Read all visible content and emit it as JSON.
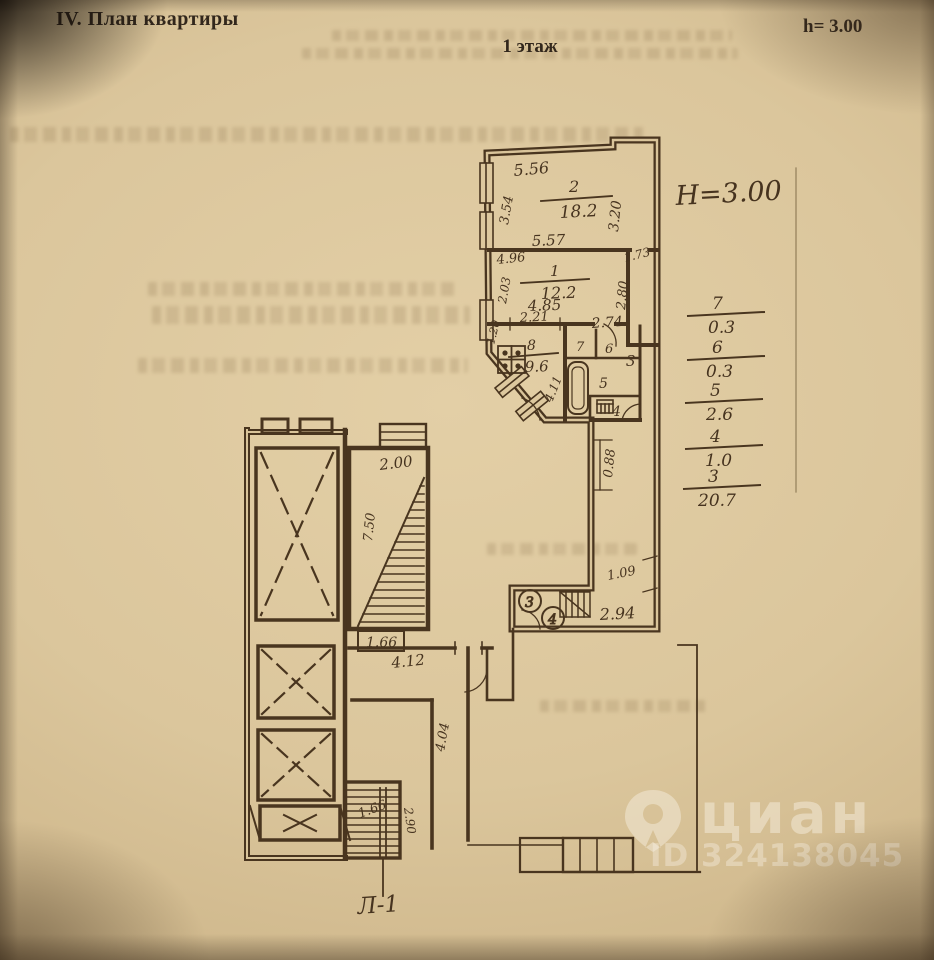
{
  "header": {
    "section_title": "IV. План квартиры",
    "floor_label": "1 этаж",
    "height_note": "h= 3.00"
  },
  "plan": {
    "height_annotation": "H=3.00",
    "stair_label": "Л-1",
    "rooms": [
      {
        "number": "2",
        "area": "18.2"
      },
      {
        "number": "1",
        "area": "12.2"
      },
      {
        "number": "8",
        "area": "9.6"
      }
    ],
    "small_room_labels": [
      "7",
      "6",
      "5",
      "4",
      "3"
    ],
    "fixture_markers": [
      "3",
      "4"
    ],
    "dimensions": {
      "room2_top": "5.56",
      "room2_left": "3.54",
      "room2_right": "3.20",
      "room2_bottom": "5.57",
      "room1_top": "4.96",
      "room1_left": "2.03",
      "room1_right_top": "1.73",
      "room1_right": "2.80",
      "room1_bottom": "4.85",
      "corridor_top": "2.74",
      "kitchen_top": "2.21",
      "kitchen_left": "1.20",
      "kitchen_diag": "4.11",
      "corridor_right": "0.88",
      "niche_top": "1.09",
      "niche_bottom": "2.94",
      "hall_top": "4.12",
      "hall_corridor": "4.04",
      "stair_top": "2.00",
      "stair_flight": "7.50",
      "stair_bottom": "1.66",
      "lower_stair": "1.66",
      "lower_stair_right": "2.90"
    }
  },
  "legend": {
    "items": [
      {
        "room": "7",
        "area": "0.3"
      },
      {
        "room": "6",
        "area": "0.3"
      },
      {
        "room": "5",
        "area": "2.6"
      },
      {
        "room": "4",
        "area": "1.0"
      },
      {
        "room": "3",
        "area": "20.7"
      }
    ]
  },
  "watermark": {
    "brand": "циан",
    "id_label": "ID 324138045"
  }
}
